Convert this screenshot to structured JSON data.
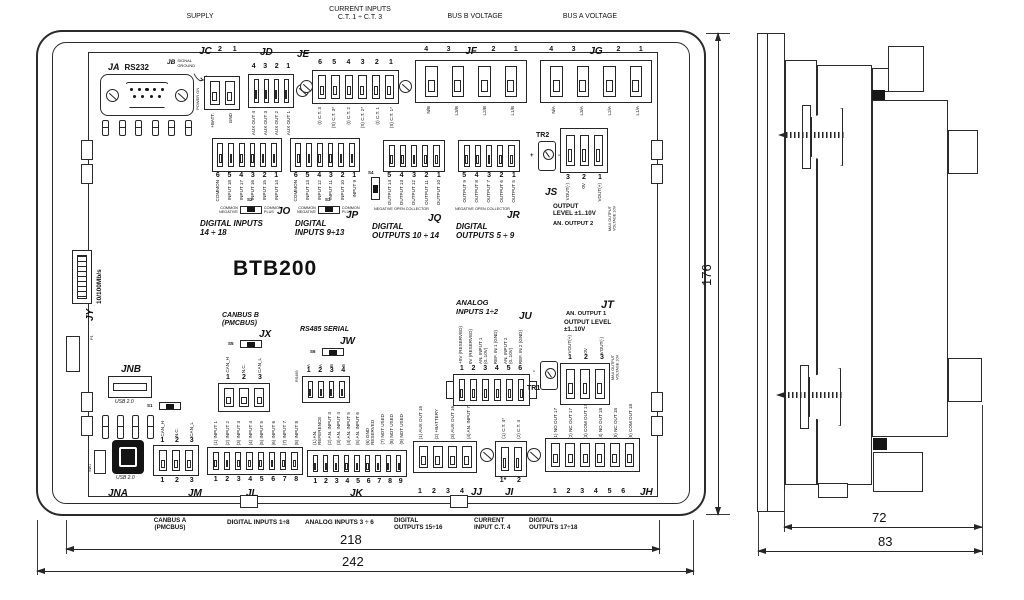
{
  "title": "BTB200",
  "top_labels": {
    "supply": "SUPPLY",
    "current_inputs": "CURRENT INPUTS\nC.T. 1 ÷ C.T. 3",
    "bus_b": "BUS B VOLTAGE",
    "bus_a": "BUS A VOLTAGE"
  },
  "connectors": {
    "ja": {
      "id": "JA",
      "label": "RS232"
    },
    "jb": {
      "id": "JB",
      "label": "SIGNAL\nGROUND"
    },
    "jc": {
      "id": "JC",
      "pin_nums": [
        "2",
        "1"
      ],
      "side_note": "POWER ON",
      "pin_labels": [
        "+BATT.",
        "GND"
      ]
    },
    "jd": {
      "id": "JD",
      "pin_nums": [
        "4",
        "3",
        "2",
        "1"
      ],
      "pin_labels": [
        "AUX OUT 4",
        "AUX OUT 3",
        "AUX OUT 2",
        "AUX OUT 1"
      ]
    },
    "je": {
      "id": "JE",
      "pin_nums": [
        "6",
        "5",
        "4",
        "3",
        "2",
        "1"
      ],
      "pin_labels": [
        "(I) C.T. 3",
        "(S) C.T. 3*",
        "(I) C.T. 2",
        "(S) C.T. 2*",
        "(I) C.T. 1",
        "(S) C.T. 1*"
      ]
    },
    "jf": {
      "id": "JF",
      "pin_nums": [
        "4",
        "3",
        "2",
        "1"
      ],
      "pin_labels": [
        "N/B",
        "L3/B",
        "L2/B",
        "L1/B"
      ]
    },
    "jg": {
      "id": "JG",
      "pin_nums": [
        "4",
        "3",
        "2",
        "1"
      ],
      "pin_labels": [
        "N/A",
        "L3/A",
        "L2/A",
        "L1/A"
      ]
    },
    "jo": {
      "id": "JO",
      "pin_nums": [
        "6",
        "5",
        "4",
        "3",
        "2",
        "1"
      ],
      "pin_labels": [
        "COMMON",
        "INPUT 18",
        "INPUT 17",
        "INPUT 16",
        "INPUT 15",
        "INPUT 14"
      ],
      "switch": "S2",
      "switch_left": "COMMON\nNEGATIVE",
      "switch_right": "COMMON\nPLUS",
      "caption": "DIGITAL INPUTS\n14 ÷ 18"
    },
    "jp": {
      "id": "JP",
      "pin_nums": [
        "6",
        "5",
        "4",
        "3",
        "2",
        "1"
      ],
      "pin_labels": [
        "COMMON",
        "INPUT 13",
        "INPUT 12",
        "INPUT 11",
        "INPUT 10",
        "INPUT 9"
      ],
      "switch": "S3",
      "switch_left": "COMMON\nNEGATIVE",
      "switch_right": "COMMON\nPLUS",
      "caption": "DIGITAL\nINPUTS 9÷13"
    },
    "jq": {
      "id": "JQ",
      "pin_nums": [
        "5",
        "4",
        "3",
        "2",
        "1"
      ],
      "pin_labels": [
        "OUTPUT 14",
        "OUTPUT 13",
        "OUTPUT 12",
        "OUTPUT 11",
        "OUTPUT 10"
      ],
      "switch": "S4",
      "note": "NEGATIVE OPEN COLLECTOR",
      "caption": "DIGITAL\nOUTPUTS 10 ÷ 14"
    },
    "jr": {
      "id": "JR",
      "pin_nums": [
        "5",
        "4",
        "3",
        "2",
        "1"
      ],
      "pin_labels": [
        "OUTPUT 9",
        "OUTPUT 8",
        "OUTPUT 7",
        "OUTPUT 6",
        "OUTPUT 5"
      ],
      "note": "NEGATIVE OPEN COLLECTOR",
      "caption": "DIGITAL\nOUTPUTS 5 ÷ 9"
    },
    "js": {
      "id": "JS",
      "trimmer": "TR2",
      "pin_nums": [
        "3",
        "2",
        "1"
      ],
      "pin_labels": [
        "VOUT(-)",
        "0V",
        "VOUT(+)"
      ],
      "caption": "OUTPUT\nLEVEL ±1..10V",
      "caption2": "AN. OUTPUT 2",
      "side_note": "MAX OUTPUT\nVOLTAGE 10V"
    },
    "jt": {
      "id": "JT",
      "trimmer": "TR1",
      "pin_nums": [
        "1",
        "2",
        "3"
      ],
      "pin_labels": [
        "VOUT(+)",
        "0V",
        "VOUT(-)"
      ],
      "caption": "AN. OUTPUT 1",
      "caption2": "OUTPUT LEVEL\n±1..10V",
      "side_note": "MAX OUTPUT\nVOLTAGE 10V"
    },
    "ju": {
      "id": "JU",
      "title": "ANALOG\nINPUTS 1÷2",
      "pin_nums": [
        "1",
        "2",
        "3",
        "4",
        "5",
        "6"
      ],
      "pin_labels": [
        "+5V (RESERVED)",
        "0V (RESERVED)",
        "AN. INPUT 1 (0..10V)",
        "REF. IN 1 (GND)",
        "AN. INPUT 2 (0..10V)",
        "REF. IN 2 (GND)"
      ]
    },
    "jx": {
      "id": "JX",
      "title": "CANBUS B\n(PMCBUS)",
      "switch": "S5",
      "pin_nums": [
        "1",
        "2",
        "3"
      ],
      "pin_labels": [
        "CAN_H",
        "N.C.",
        "CAN_L"
      ]
    },
    "jw": {
      "id": "JW",
      "title": "RS485 SERIAL",
      "switch": "S6",
      "side_note": "RS485",
      "pin_nums": [
        "1",
        "2",
        "3",
        "4"
      ],
      "pin_labels": [
        "A",
        "A",
        "B",
        "B"
      ]
    },
    "jy": {
      "id": "JY",
      "label": "10/100Mb/s",
      "sub_label": "P1"
    },
    "jnb": {
      "id": "JNB",
      "label": "USB 2.0"
    },
    "jna": {
      "id": "JNA",
      "label": "USB 2.0"
    },
    "sw1": {
      "id": "SW1"
    },
    "jm": {
      "id": "JM",
      "switch": "S1",
      "pin_labels": [
        "CAN_H",
        "N.C.",
        "CAN_L"
      ],
      "pin_nums_top": [
        "1",
        "2",
        "3"
      ],
      "pin_nums_bottom": [
        "1",
        "2",
        "3"
      ]
    },
    "jl": {
      "id": "JL",
      "pin_labels": [
        "(1) INPUT 1",
        "(2) INPUT 2",
        "(3) INPUT 3",
        "(4) INPUT 4",
        "(5) INPUT 5",
        "(6) INPUT 6",
        "(7) INPUT 7",
        "(8) INPUT 8"
      ],
      "pin_nums": [
        "1",
        "2",
        "3",
        "4",
        "5",
        "6",
        "7",
        "8"
      ]
    },
    "jk": {
      "id": "JK",
      "pin_labels": [
        "(1) AN. REFERENCE",
        "(2) AN. INPUT 3",
        "(3) AN. INPUT 4",
        "(4) AN. INPUT 5",
        "(5) AN. INPUT 6",
        "(6) GND RESERVED",
        "(7) NOT USED",
        "(8) NOT USED",
        "(9) NOT USED"
      ],
      "pin_nums": [
        "1",
        "2",
        "3",
        "4",
        "5",
        "6",
        "7",
        "8",
        "9"
      ]
    },
    "jj": {
      "id": "JJ",
      "pin_labels": [
        "(1) AUX OUT 15",
        "(2) +BATTERY",
        "(3) AUX OUT 16",
        "(4) AN. INPUT 7"
      ],
      "pin_nums": [
        "1",
        "2",
        "3",
        "4"
      ]
    },
    "ji": {
      "id": "JI",
      "pin_labels": [
        "(1) C.T. 4*",
        "(2) C.T. 4"
      ],
      "pin_nums": [
        "1*",
        "2"
      ]
    },
    "jh": {
      "id": "JH",
      "pin_labels": [
        "(1) NO OUT 17",
        "(2) NC OUT 17",
        "(3) COM OUT 17",
        "(4) NO OUT 18",
        "(5) NC OUT 18",
        "(6) COM OUT 18"
      ],
      "pin_nums": [
        "1",
        "2",
        "3",
        "4",
        "5",
        "6"
      ]
    }
  },
  "bottom_captions": [
    "CANBUS A\n(PMCBUS)",
    "DIGITAL INPUTS 1÷8",
    "ANALOG INPUTS 3 ÷ 6",
    "DIGITAL\nOUTPUTS 15÷16",
    "CURRENT\nINPUT  C.T. 4",
    "DIGITAL\nOUTPUTS 17÷18"
  ],
  "dimensions": {
    "width_outer": "242",
    "width_inner": "218",
    "height": "176",
    "depth_body": "72",
    "depth_total": "83"
  }
}
